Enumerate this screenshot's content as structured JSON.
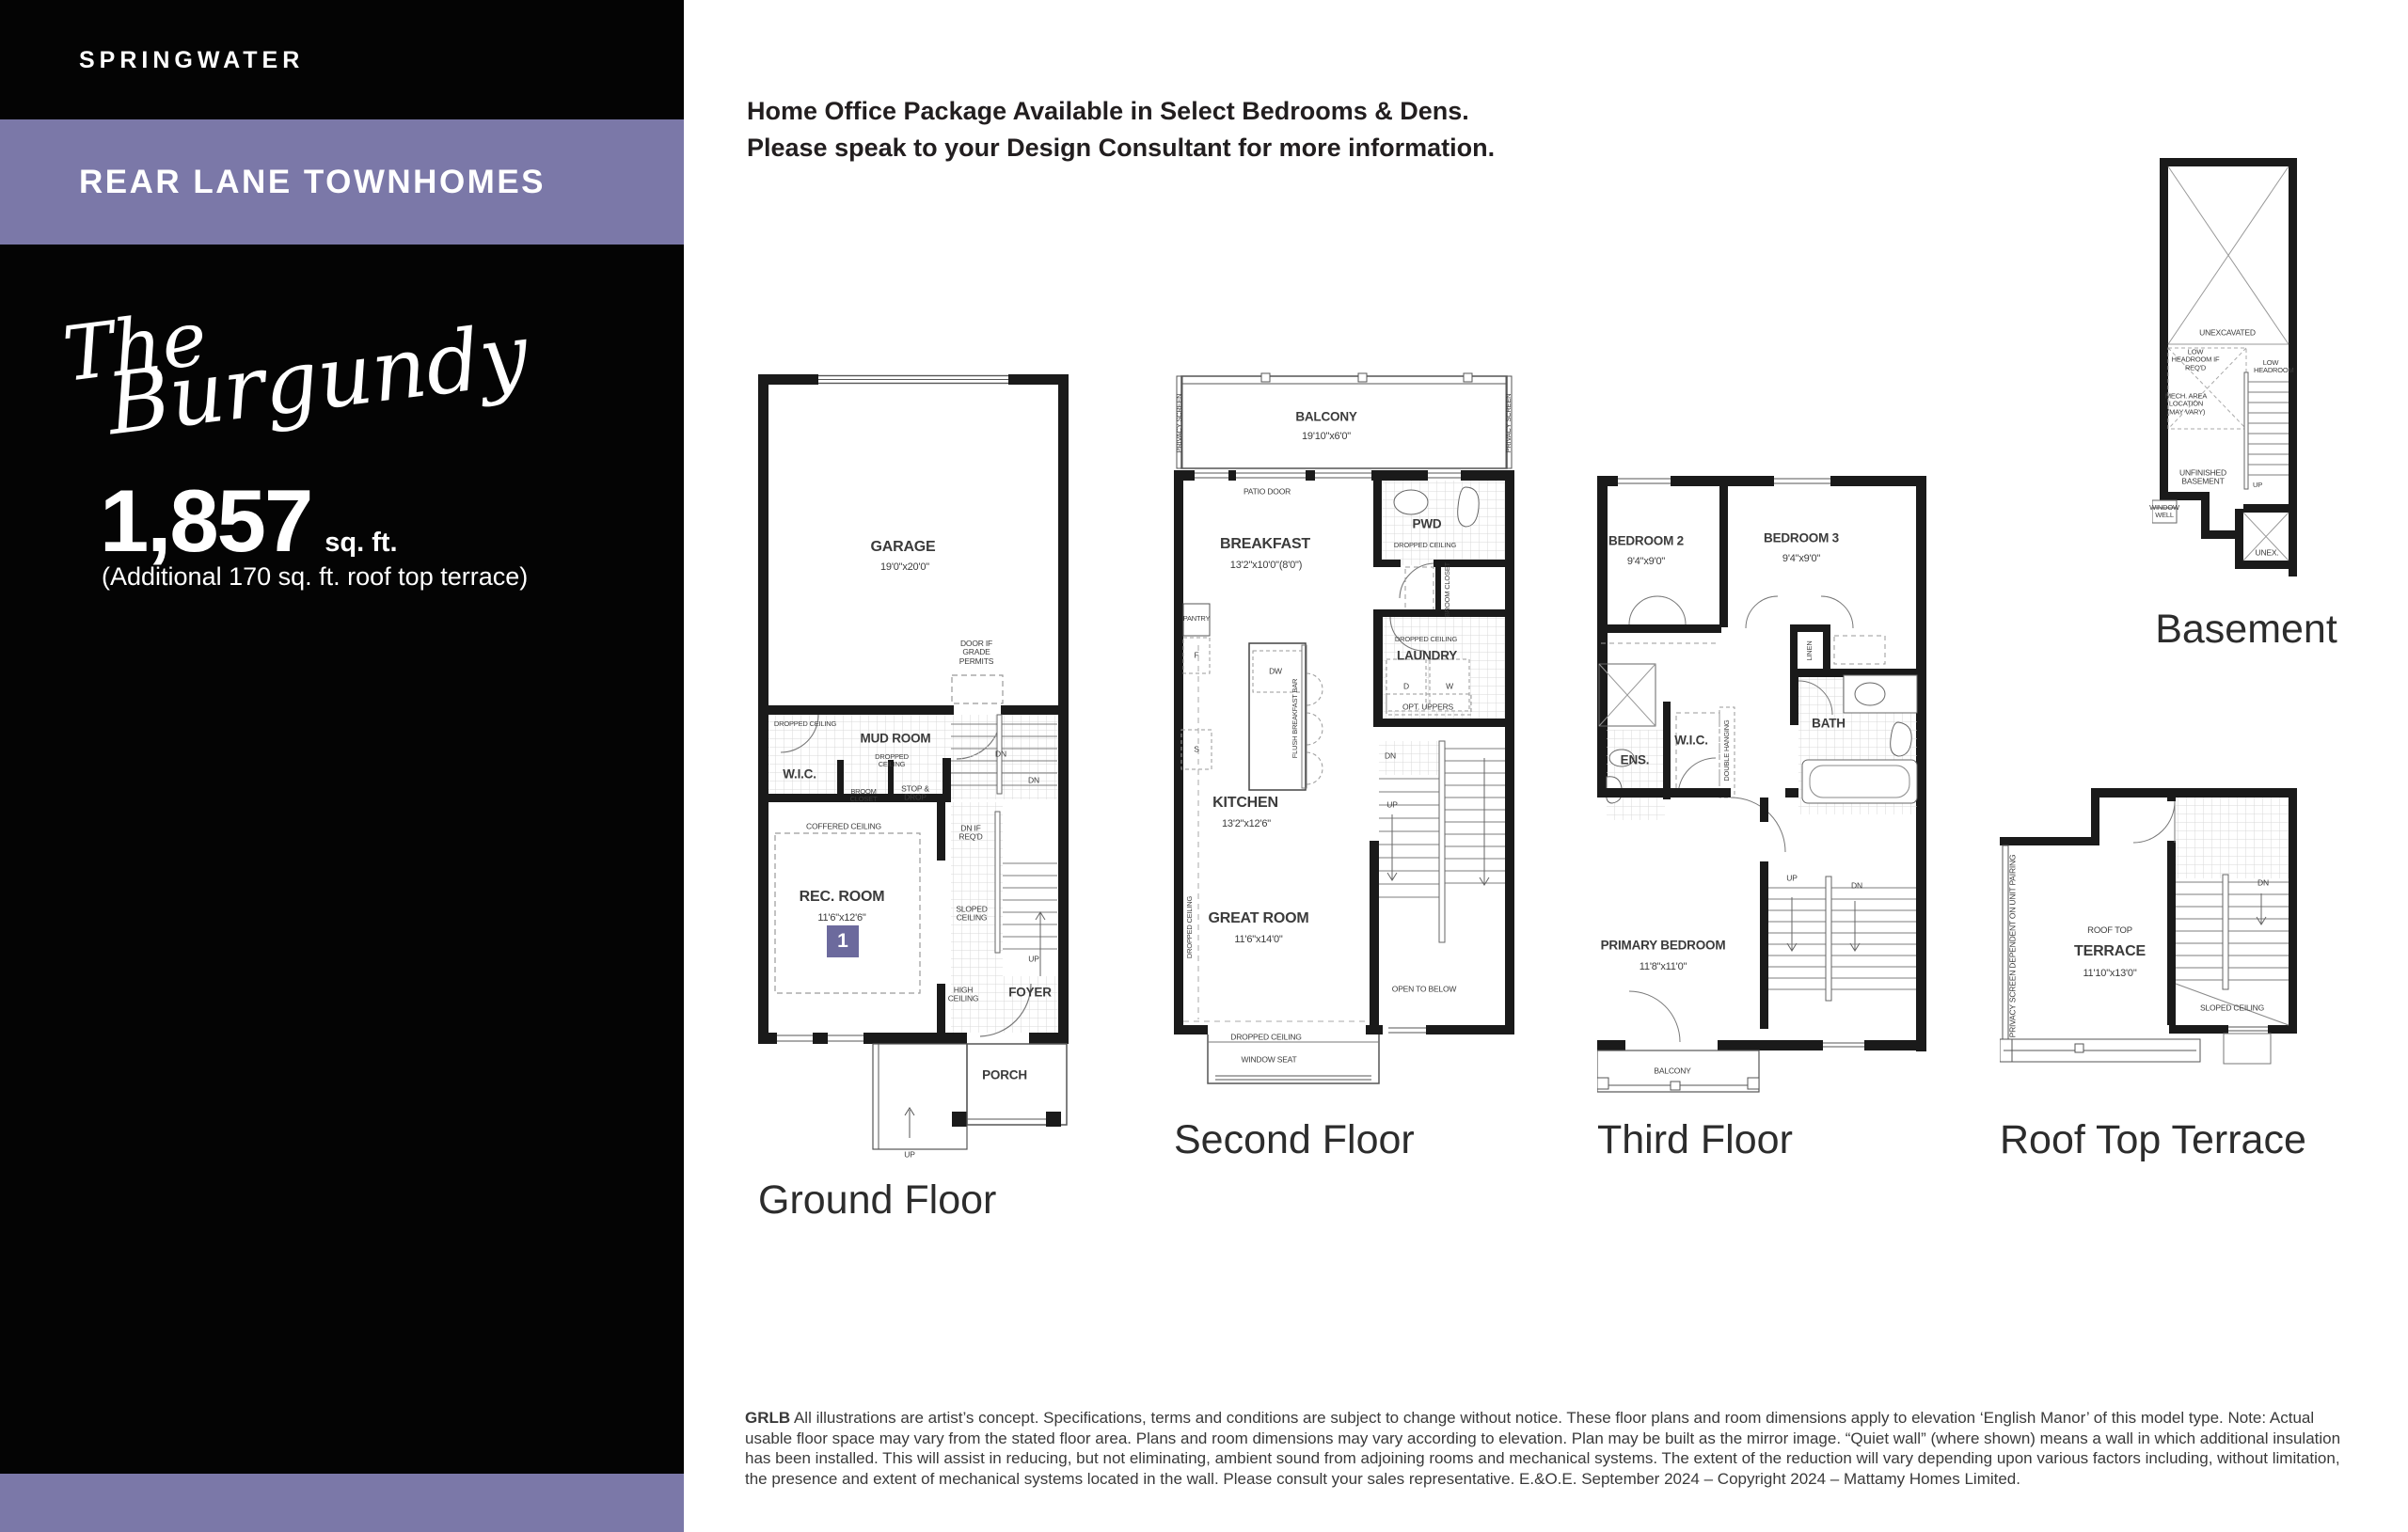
{
  "colors": {
    "accent": "#7b78a8",
    "badge": "#6c6a9d",
    "wall": "#1a1a1a"
  },
  "sidebar": {
    "community": "SPRINGWATER",
    "collection": "REAR LANE TOWNHOMES",
    "model_name_line1": "The",
    "model_name_line2": "Burgundy",
    "area_value": "1,857",
    "area_unit": "sq. ft.",
    "area_note": "(Additional 170 sq. ft. roof top terrace)"
  },
  "header": {
    "line1": "Home Office Package Available in Select Bedrooms & Dens.",
    "line2": "Please speak to your Design Consultant for more information."
  },
  "plans": {
    "ground": {
      "label": "Ground Floor",
      "garage": "GARAGE",
      "garage_dims": "19'0\"x20'0\"",
      "door_grade": "DOOR IF GRADE PERMITS",
      "dropped_ceiling": "DROPPED CEILING",
      "mud_room": "MUD ROOM",
      "mud_dropped": "DROPPED CEILING",
      "wic": "W.I.C.",
      "dn": "DN",
      "dn2": "DN",
      "broom": "BROOM CLOSET",
      "stop_drop": "STOP & DROP",
      "dn_if_reqd": "DN IF REQ'D",
      "coffered": "COFFERED CEILING",
      "rec_room": "REC. ROOM",
      "rec_dims": "11'6\"x12'6\"",
      "badge": "1",
      "sloped": "SLOPED CEILING",
      "up": "UP",
      "high": "HIGH CEILING",
      "foyer": "FOYER",
      "porch": "PORCH",
      "up2": "UP"
    },
    "second": {
      "label": "Second Floor",
      "privacy_left": "PRIVACY SCREEN",
      "privacy_right": "PRIVACY SCREEN",
      "balcony": "BALCONY",
      "balcony_dims": "19'10\"x6'0\"",
      "patio": "PATIO DOOR",
      "breakfast": "BREAKFAST",
      "breakfast_dims": "13'2\"x10'0\"(8'0\")",
      "pwd": "PWD",
      "pwd_dropped": "DROPPED CEILING",
      "broom": "BROOM CLOSET",
      "laundry_dropped": "DROPPED CEILING",
      "laundry": "LAUNDRY",
      "d": "D",
      "w": "W",
      "opt_uppers": "OPT. UPPERS",
      "pantry": "PANTRY",
      "f": "F",
      "s": "S",
      "dw": "DW",
      "flush_bar": "FLUSH BREAKFAST BAR",
      "kitchen": "KITCHEN",
      "kitchen_dims": "13'2\"x12'6\"",
      "dropped_vert": "DROPPED CEILING",
      "great": "GREAT ROOM",
      "great_dims": "11'6\"x14'0\"",
      "dn": "DN",
      "up": "UP",
      "open_below": "OPEN TO BELOW",
      "dropped_bottom": "DROPPED CEILING",
      "window_seat": "WINDOW SEAT"
    },
    "third": {
      "label": "Third Floor",
      "bedroom2": "BEDROOM 2",
      "bedroom2_dims": "9'4\"x9'0\"",
      "bedroom3": "BEDROOM 3",
      "bedroom3_dims": "9'4\"x9'0\"",
      "linen": "LINEN",
      "ens": "ENS.",
      "wic": "W.I.C.",
      "double_hanging": "DOUBLE HANGING",
      "bath": "BATH",
      "primary": "PRIMARY BEDROOM",
      "primary_dims": "11'8\"x11'0\"",
      "up": "UP",
      "dn": "DN",
      "balcony": "BALCONY"
    },
    "basement": {
      "label": "Basement",
      "unexcavated": "UNEXCAVATED",
      "low_head_reqd": "LOW HEADROOM IF REQ'D",
      "low_head": "LOW HEADROOM",
      "mech": "MECH. AREA LOCATION (MAY VARY)",
      "unfinished": "UNFINISHED BASEMENT",
      "window_well": "WINDOW WELL",
      "up": "UP",
      "unex": "UNEX."
    },
    "terrace": {
      "label": "Roof Top Terrace",
      "privacy_note": "PRIVACY SCREEN DEPENDENT ON UNIT PAIRING",
      "roof_top": "ROOF TOP",
      "terrace": "TERRACE",
      "terrace_dims": "11'10\"x13'0\"",
      "dn": "DN",
      "sloped": "SLOPED CEILING"
    }
  },
  "disclaimer": {
    "code": "GRLB",
    "text": " All illustrations are artist’s concept. Specifications, terms and conditions are subject to change without notice. These floor plans and room dimensions apply to elevation ‘English Manor’ of this model type. Note: Actual usable floor space may vary from the stated floor area. Plans and room dimensions may vary according to elevation. Plan may be built as the mirror image. “Quiet wall” (where shown) means a wall in which additional insulation has been installed. This will assist in reducing, but not eliminating, ambient sound from adjoining rooms and mechanical systems. The extent of the reduction will vary depending upon various factors including, without limitation, the presence and extent of mechanical systems located in the wall. Please consult your sales representative. E.&O.E. September 2024 – Copyright 2024 – Mattamy Homes Limited."
  }
}
